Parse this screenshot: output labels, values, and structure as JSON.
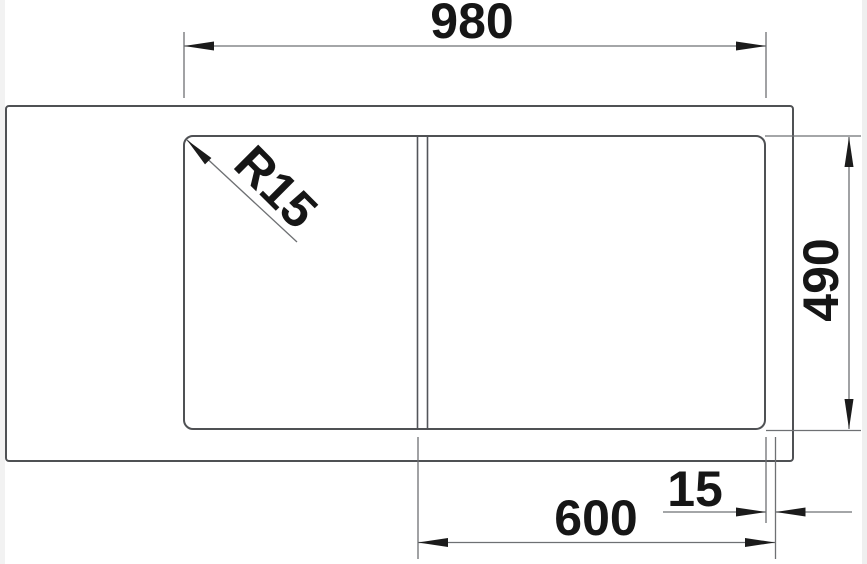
{
  "diagram": {
    "kind": "sink-cutout-technical-drawing",
    "units": "mm",
    "labels": {
      "overall_width": "980",
      "overall_depth": "490",
      "bowl_section_width": "600",
      "clearance": "15",
      "corner_radius": "R15"
    },
    "colors": {
      "background": "#ffffff",
      "outline": "#4f5154",
      "dimension_line": "#6e7073",
      "arrow_and_text": "#1b1b1b",
      "edge_strip": "#f2f2f2"
    }
  }
}
